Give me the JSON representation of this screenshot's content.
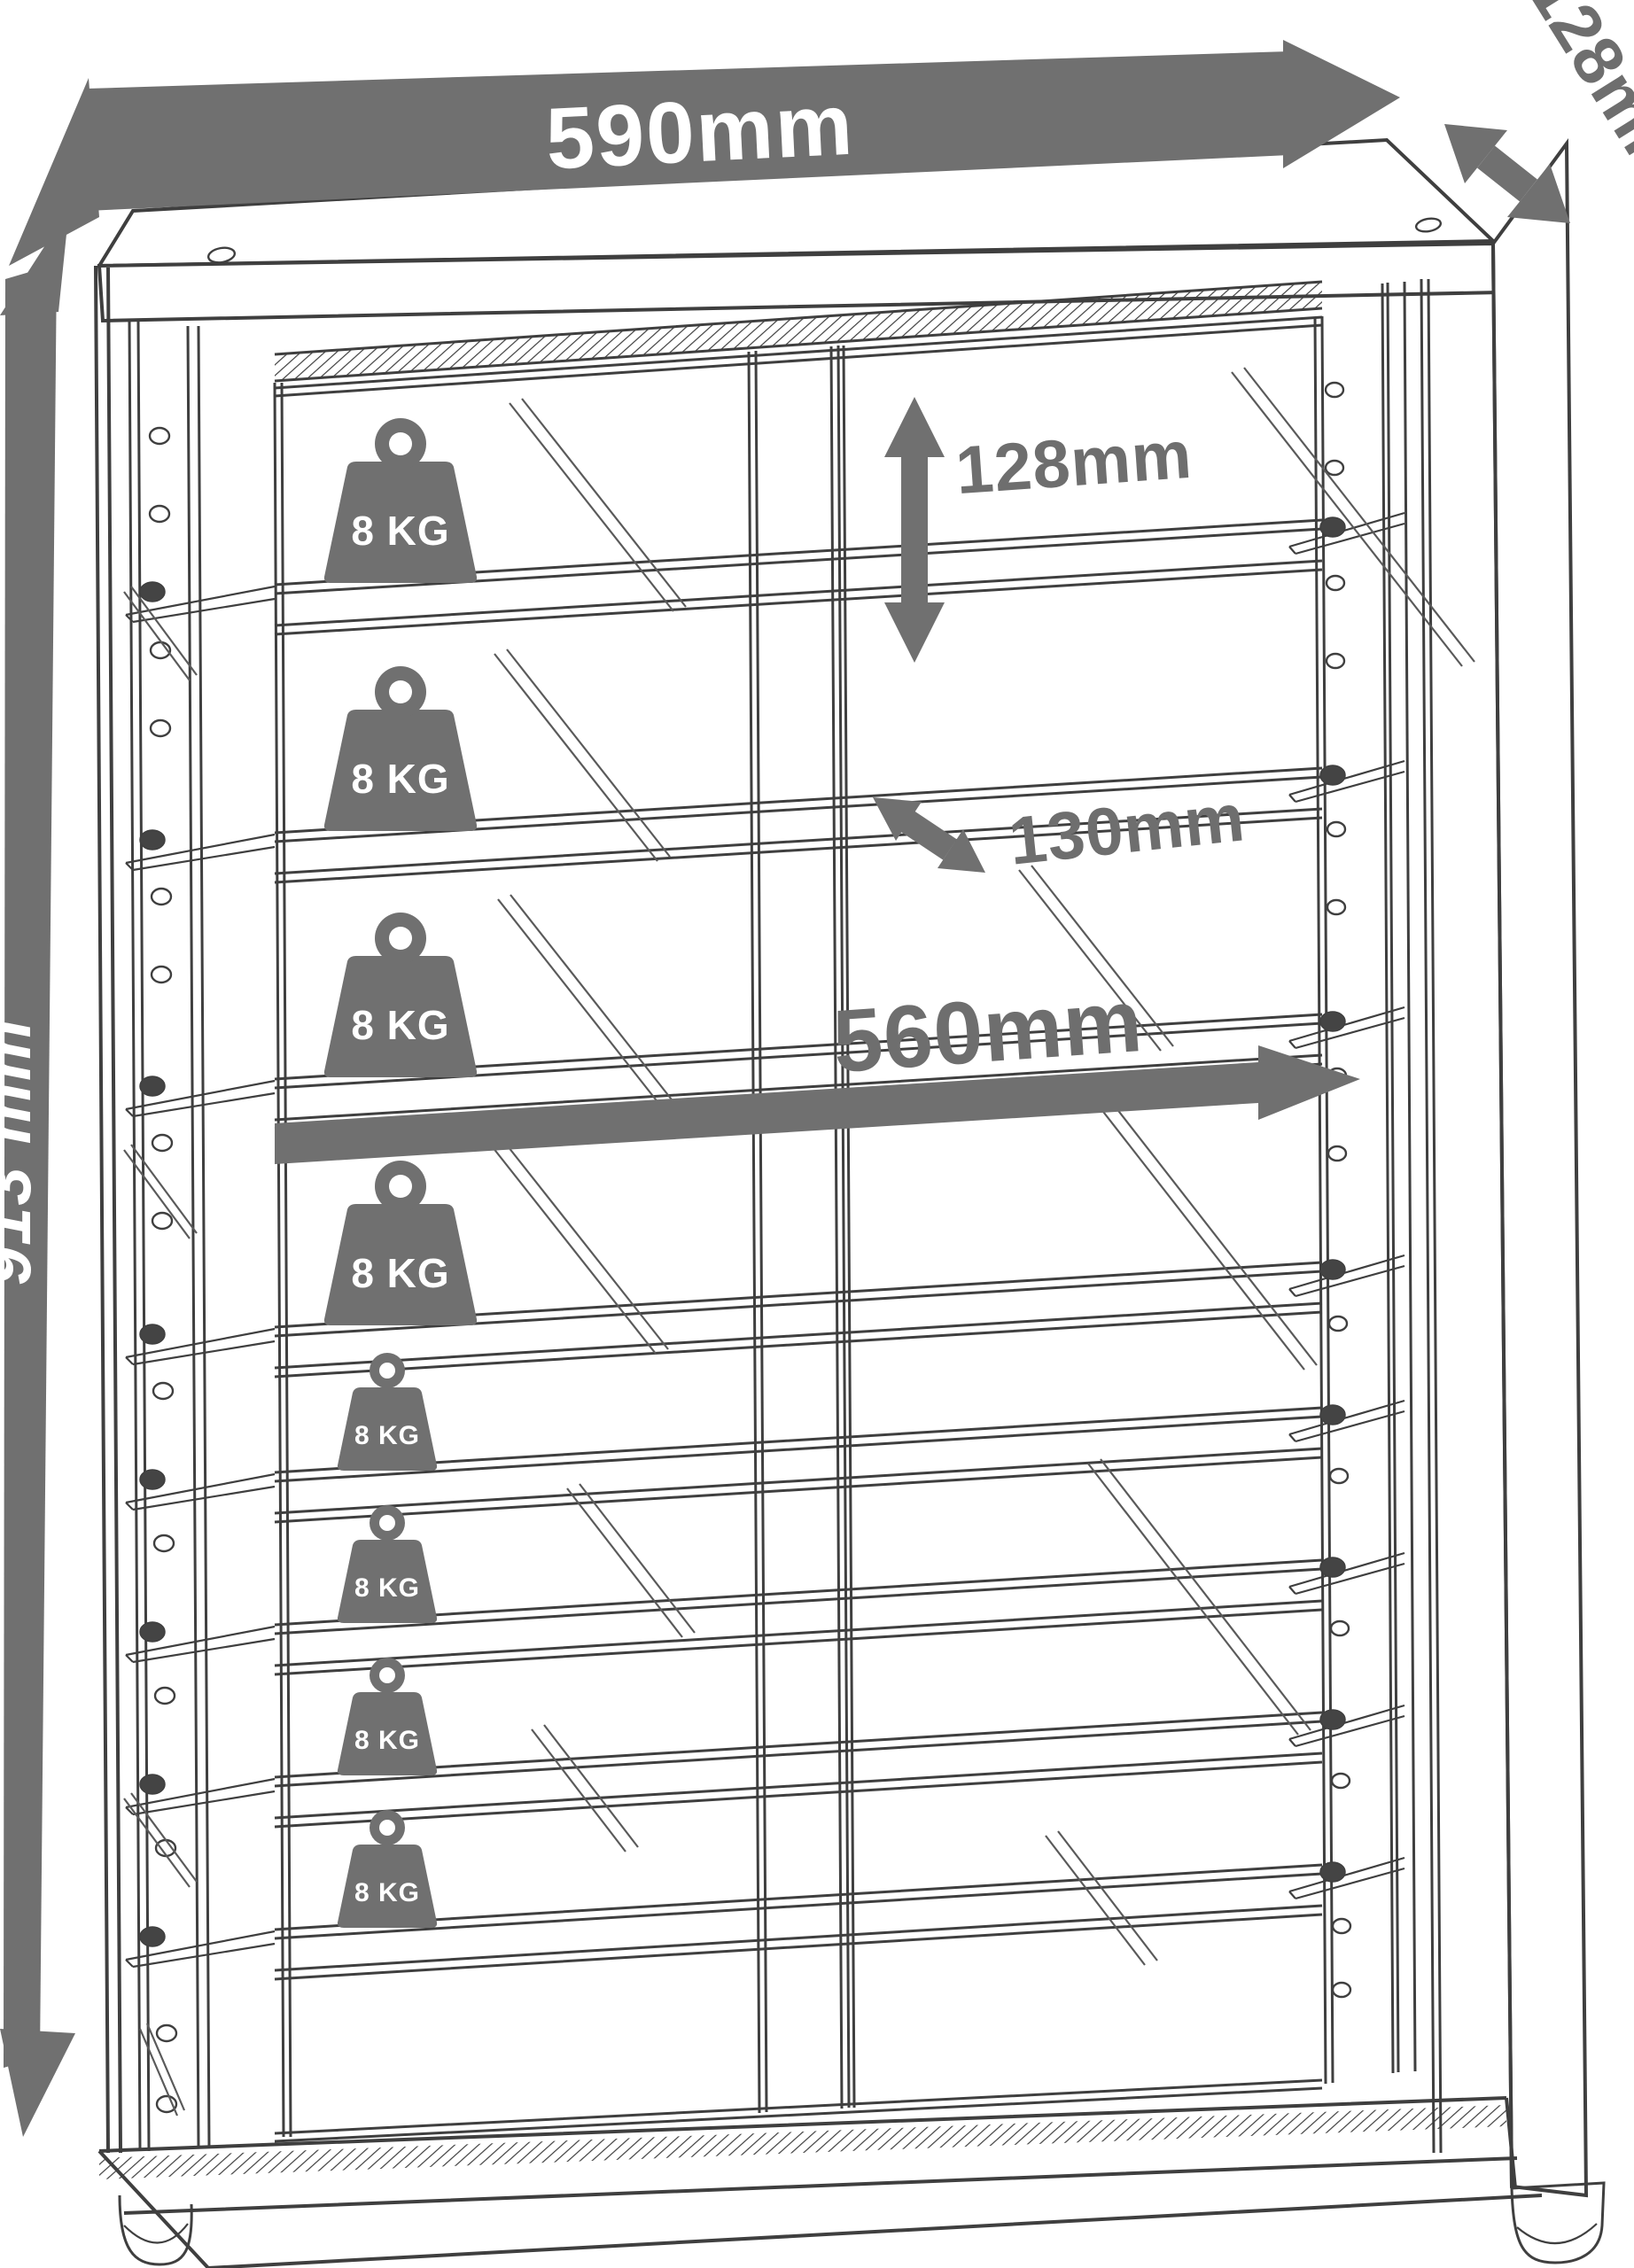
{
  "diagram": {
    "type": "technical-dimension-drawing",
    "subject": "Display cabinet with sliding glass doors, glass shelves, shelf pin holes and adjustable feet",
    "dimensions": {
      "overall_width": "590mm",
      "overall_depth": "128mm",
      "overall_height": "913 mm",
      "shelf_spacing": "128mm",
      "shelf_depth": "130mm",
      "interior_width": "560mm"
    },
    "shelf_load_capacity": "8 KG",
    "weights": [
      {
        "label": "8 KG",
        "size": "large"
      },
      {
        "label": "8 KG",
        "size": "large"
      },
      {
        "label": "8 KG",
        "size": "large"
      },
      {
        "label": "8 KG",
        "size": "large"
      },
      {
        "label": "8 KG",
        "size": "small"
      },
      {
        "label": "8 KG",
        "size": "small"
      },
      {
        "label": "8 KG",
        "size": "small"
      },
      {
        "label": "8 KG",
        "size": "small"
      }
    ],
    "colors": {
      "accent_gray": "#707070",
      "line": "#3f3f3f",
      "background": "#ffffff",
      "label_on_gray": "#ffffff"
    }
  }
}
